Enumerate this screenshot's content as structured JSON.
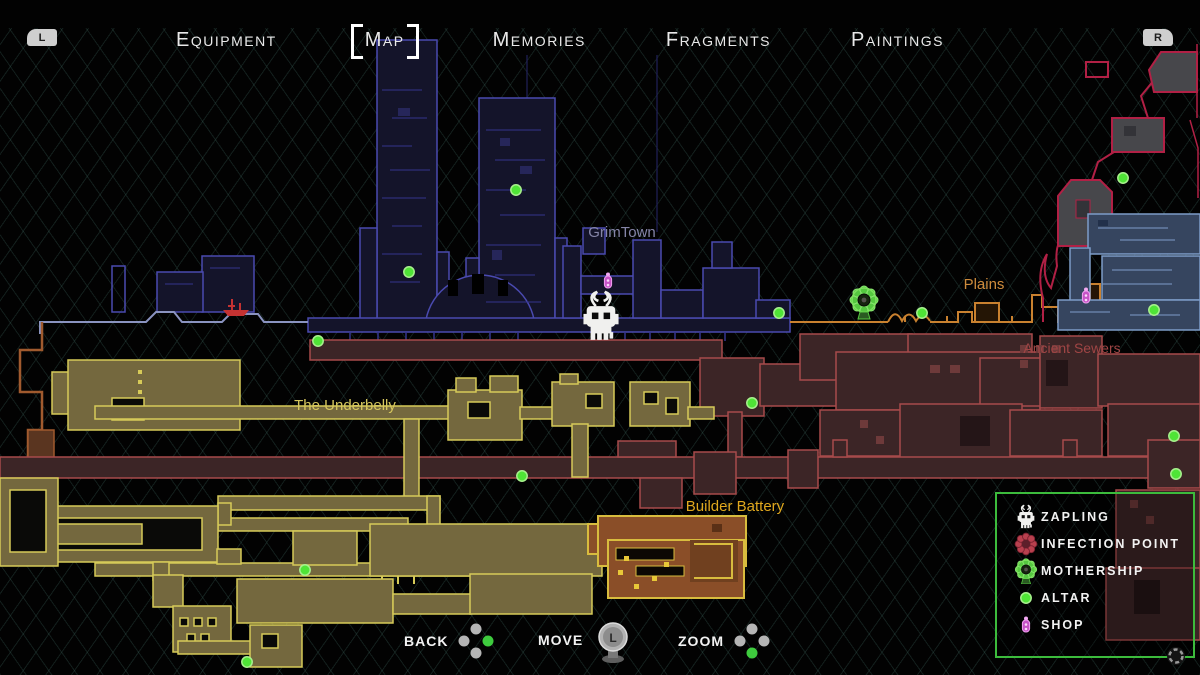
{
  "header": {
    "left_shoulder": "L",
    "right_shoulder": "R",
    "tabs": [
      {
        "label": "Equipment",
        "active": false
      },
      {
        "label": "Map",
        "active": true
      },
      {
        "label": "Memories",
        "active": false
      },
      {
        "label": "Fragments",
        "active": false
      },
      {
        "label": "Paintings",
        "active": false
      }
    ]
  },
  "map": {
    "region_labels": [
      {
        "id": "grimtown",
        "text": "GrimTown",
        "x": 622,
        "y": 237,
        "color": "#8585a8",
        "size": 15
      },
      {
        "id": "plains",
        "text": "Plains",
        "x": 984,
        "y": 289,
        "color": "#cd8b3c",
        "size": 15
      },
      {
        "id": "ancient-sewers",
        "text": "Ancient Sewers",
        "x": 1072,
        "y": 353,
        "color": "#a04545",
        "size": 14
      },
      {
        "id": "the-underbelly",
        "text": "The Underbelly",
        "x": 345,
        "y": 410,
        "color": "#d6c75e",
        "size": 15
      },
      {
        "id": "builder-battery",
        "text": "Builder Battery",
        "x": 735,
        "y": 511,
        "color": "#e0a81e",
        "size": 15
      }
    ],
    "markers": {
      "altars": [
        [
          516,
          190
        ],
        [
          409,
          272
        ],
        [
          318,
          341
        ],
        [
          779,
          313
        ],
        [
          922,
          313
        ],
        [
          1123,
          178
        ],
        [
          1154,
          310
        ],
        [
          752,
          403
        ],
        [
          1174,
          436
        ],
        [
          1176,
          474
        ],
        [
          522,
          476
        ],
        [
          305,
          570
        ],
        [
          247,
          662
        ]
      ],
      "shops": [
        [
          608,
          282
        ],
        [
          1086,
          297
        ]
      ],
      "mothership": [
        864,
        300
      ],
      "player": [
        601,
        323
      ],
      "ship": [
        236,
        308
      ]
    },
    "colors": {
      "background": "#000000",
      "hatch_line": "#2b4a45",
      "grimtown_fill": "#14142a",
      "grimtown_stroke": "#4a4ab0",
      "underbelly_fill": "#74683e",
      "underbelly_stroke": "#d6ca58",
      "sewers_fill": "#3c2526",
      "sewers_stroke": "#a74b4b",
      "battery_fill": "#8a4e28",
      "battery_stroke": "#d8bc3e",
      "plains_stroke": "#c9812f",
      "ridge_stroke": "#b12045",
      "blue_fill": "#36455f",
      "blue_stroke": "#7d9cc8",
      "altar": "#4fe436",
      "shop": "#d55fd5",
      "legend_border": "#3cbb3c",
      "active_dot": "#3ecb3e"
    }
  },
  "legend": {
    "title_hidden": "",
    "items": [
      {
        "icon": "zapling-icon",
        "label": "ZAPLING"
      },
      {
        "icon": "infection-point-icon",
        "label": "INFECTION POINT"
      },
      {
        "icon": "mothership-icon",
        "label": "MOTHERSHIP"
      },
      {
        "icon": "altar-icon",
        "label": "ALTAR"
      },
      {
        "icon": "shop-icon",
        "label": "SHOP"
      }
    ]
  },
  "controls": [
    {
      "label": "Back",
      "icon": "dpad-right-icon"
    },
    {
      "label": "Move",
      "icon": "left-stick-icon",
      "stick_label": "L"
    },
    {
      "label": "Zoom",
      "icon": "dpad-down-icon"
    }
  ]
}
